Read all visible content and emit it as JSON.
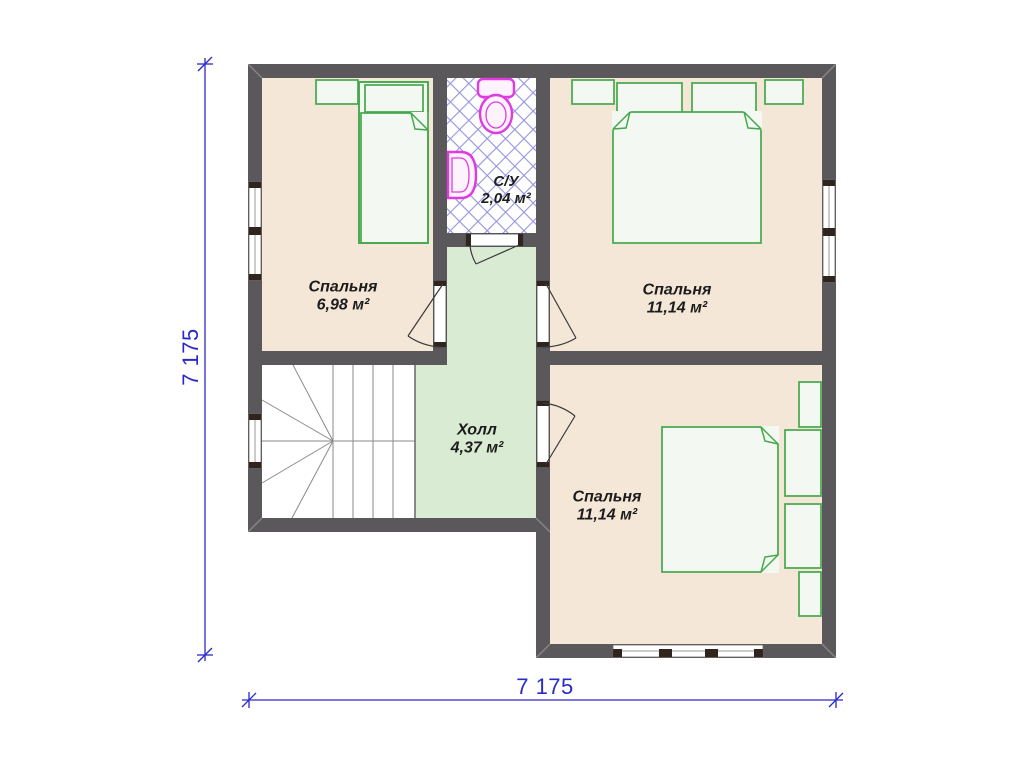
{
  "plan": {
    "type_label": "floor plan (second storey)",
    "rooms": [
      {
        "id": "bedroom-top-left",
        "name": "Спальня",
        "area": "6,98 м²"
      },
      {
        "id": "bathroom",
        "name": "С/У",
        "area": "2,04 м²"
      },
      {
        "id": "bedroom-top-right",
        "name": "Спальня",
        "area": "11,14 м²"
      },
      {
        "id": "hall",
        "name": "Холл",
        "area": "4,37 м²"
      },
      {
        "id": "bedroom-bottom-right",
        "name": "Спальня",
        "area": "11,14 м²"
      }
    ],
    "dimensions": {
      "width": "7 175",
      "height": "7 175"
    }
  },
  "colors": {
    "wall": "#5a585a",
    "bedroom_floor": "#f5e7d7",
    "hall_floor": "#d9ecd3",
    "furniture_outline": "#44a84c",
    "sanitary_outline": "#e23ae2",
    "tile_line": "#8383d8",
    "dimension": "#2a2ac8",
    "label_text": "#1c1c1c"
  }
}
